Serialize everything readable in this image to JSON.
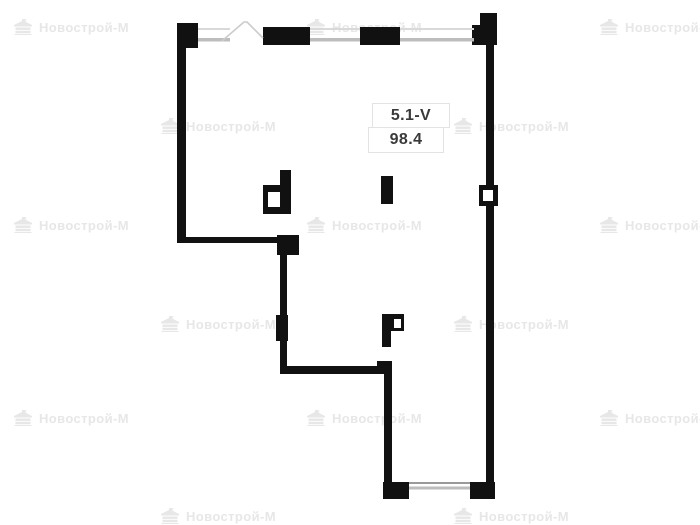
{
  "meta": {
    "width": 700,
    "height": 525,
    "background": "#ffffff"
  },
  "unit": {
    "id": "5.1-V",
    "area": "98.4"
  },
  "watermark": {
    "text": "Новострой-М",
    "icon": "building-logo-icon",
    "color": "#e7e7e7",
    "positions": [
      {
        "x": 13,
        "y": 19
      },
      {
        "x": 306,
        "y": 19
      },
      {
        "x": 599,
        "y": 19
      },
      {
        "x": 160,
        "y": 118
      },
      {
        "x": 453,
        "y": 118
      },
      {
        "x": 13,
        "y": 217
      },
      {
        "x": 306,
        "y": 217
      },
      {
        "x": 599,
        "y": 217
      },
      {
        "x": 160,
        "y": 316
      },
      {
        "x": 453,
        "y": 316
      },
      {
        "x": 13,
        "y": 410
      },
      {
        "x": 306,
        "y": 410
      },
      {
        "x": 599,
        "y": 410
      },
      {
        "x": 160,
        "y": 508
      },
      {
        "x": 453,
        "y": 508
      }
    ]
  },
  "colors": {
    "wall": "#111111",
    "window_line": "#d9d9d9",
    "window_line_dark": "#9a9a9a",
    "window_band": "#bdbdbd",
    "diagonal": "#cccccc",
    "label_border": "#e3e3e3",
    "label_text": "#3a3a3a",
    "watermark": "#e7e7e7"
  }
}
